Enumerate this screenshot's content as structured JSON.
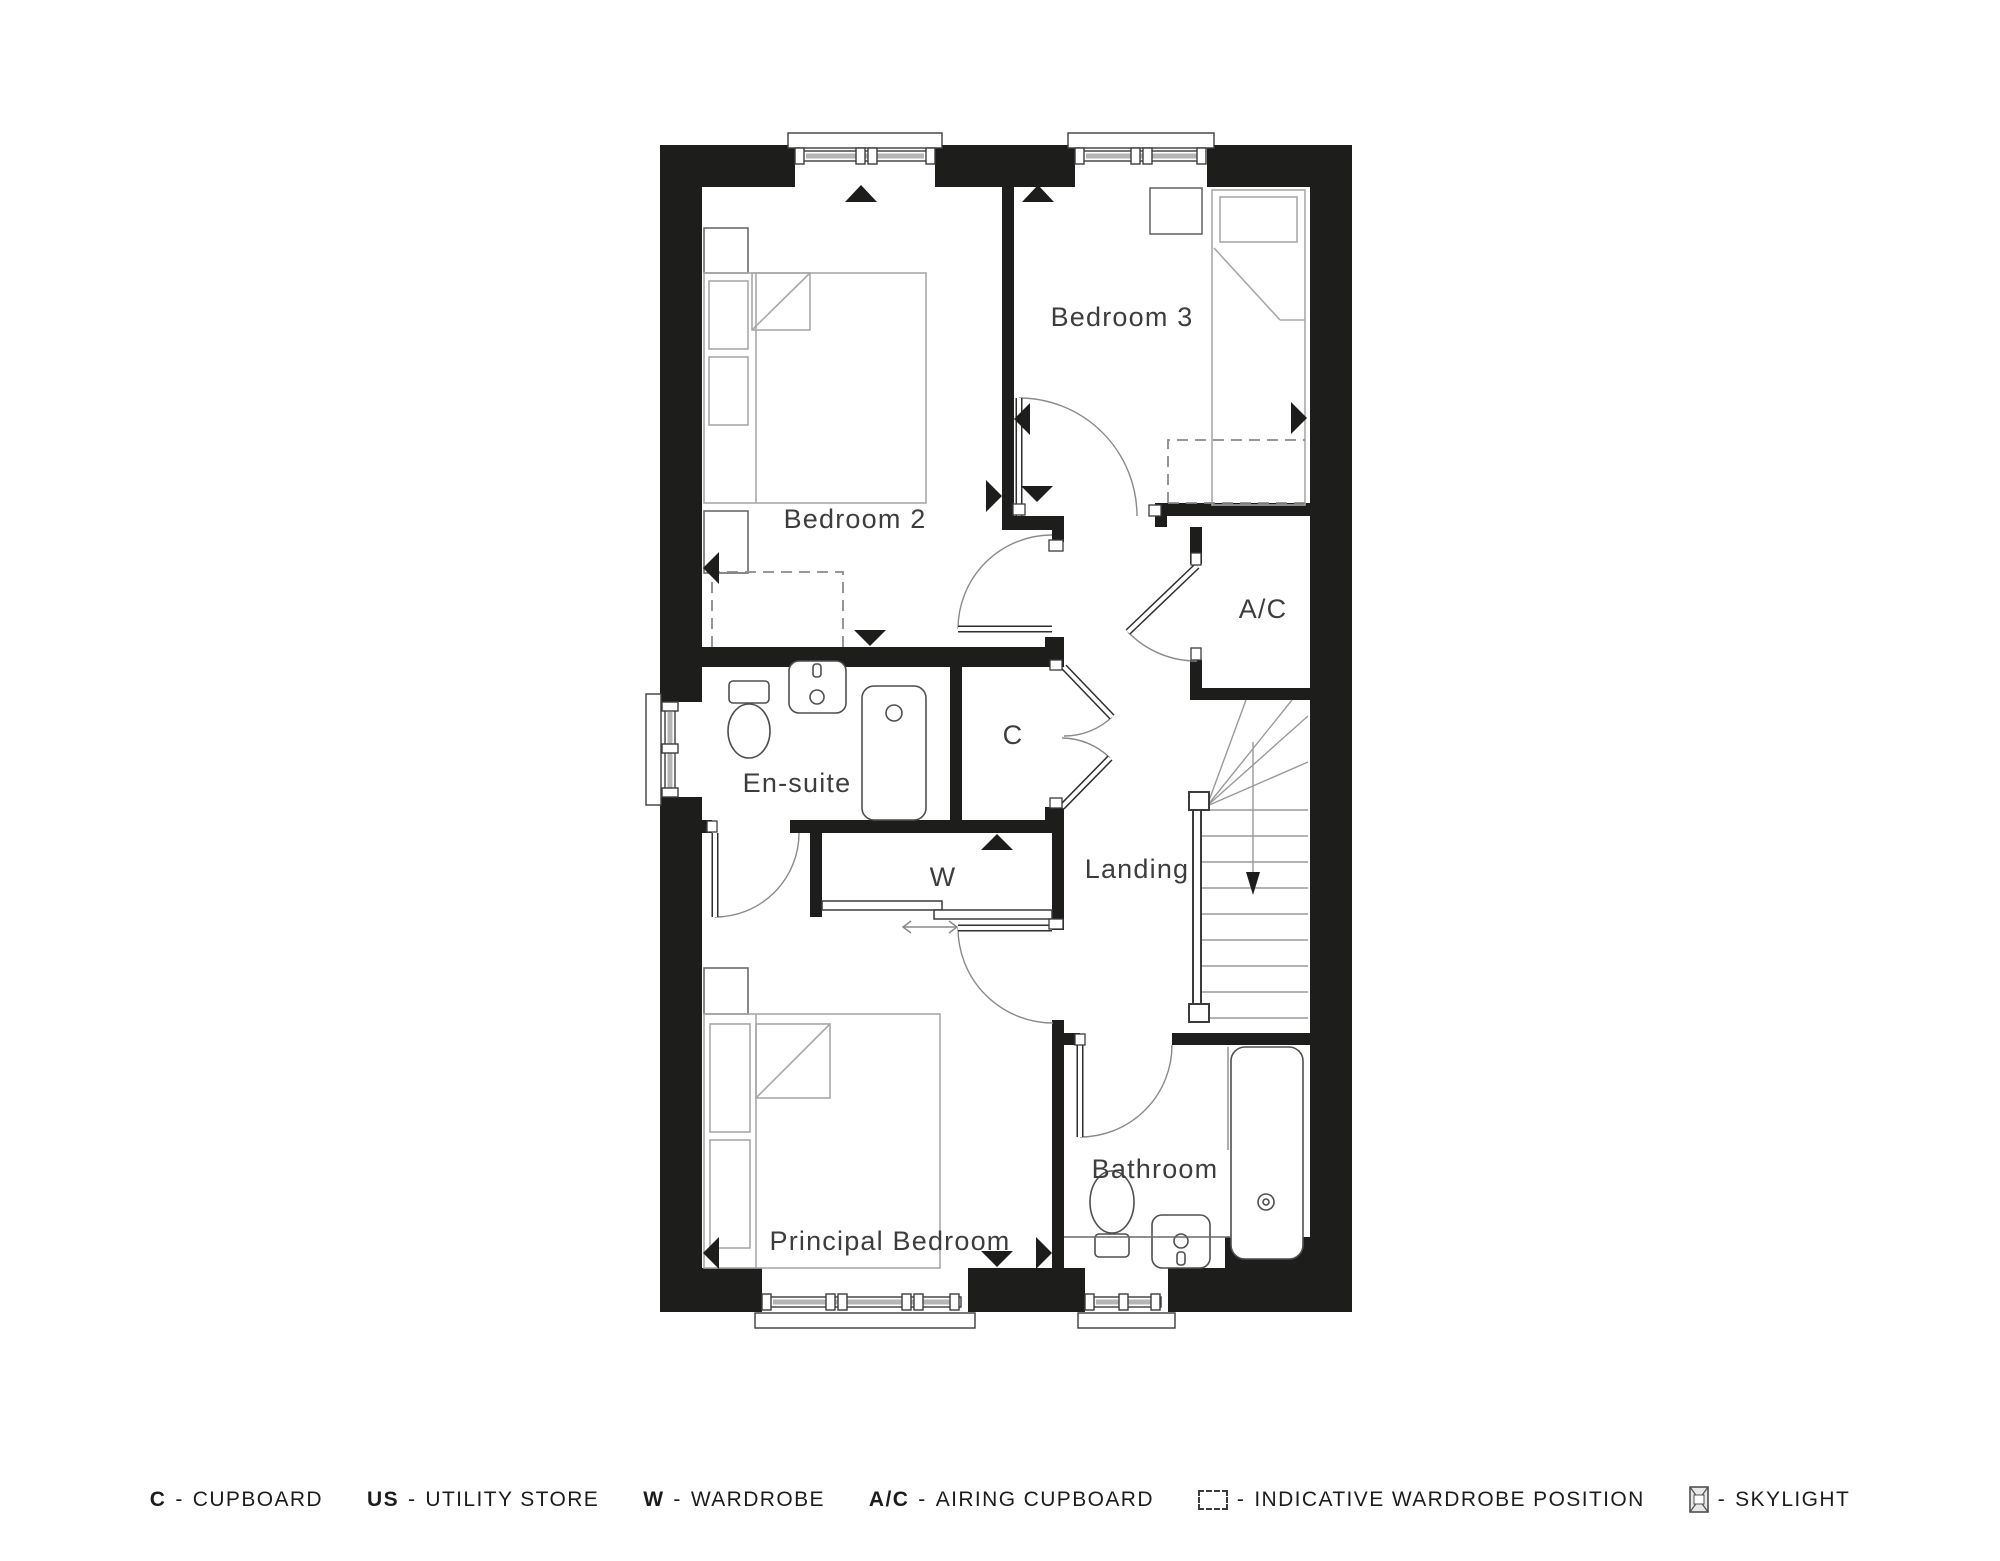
{
  "plan": {
    "rooms": {
      "bedroom2": "Bedroom 2",
      "bedroom3": "Bedroom 3",
      "ensuite": "En-suite",
      "cupboard": "C",
      "wardrobe": "W",
      "landing": "Landing",
      "airing_cupboard": "A/C",
      "bathroom": "Bathroom",
      "principal_bedroom": "Principal Bedroom"
    }
  },
  "legend": {
    "dash": "-",
    "items": [
      {
        "abbr": "C",
        "label": "CUPBOARD"
      },
      {
        "abbr": "US",
        "label": "UTILITY STORE"
      },
      {
        "abbr": "W",
        "label": "WARDROBE"
      },
      {
        "abbr": "A/C",
        "label": "AIRING CUPBOARD"
      },
      {
        "icon": "dashed-box-icon",
        "label": "INDICATIVE WARDROBE POSITION"
      },
      {
        "icon": "skylight-icon",
        "label": "SKYLIGHT"
      }
    ]
  },
  "colors": {
    "wall": "#1d1d1b",
    "furniture_line": "#a8a8a8",
    "fixture_line": "#4f4f4f",
    "door_arc": "#8a8a8a",
    "background": "#ffffff"
  }
}
